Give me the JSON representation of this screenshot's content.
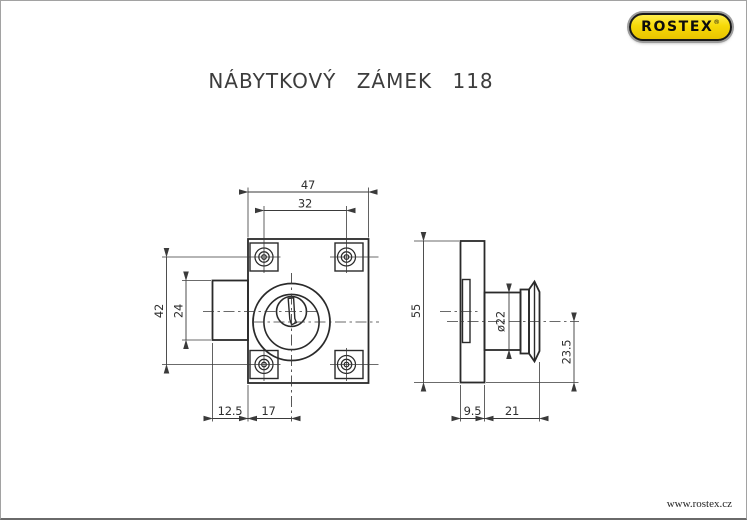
{
  "page": {
    "title": "NÁBYTKOVÝ ZÁMEK 118",
    "website": "www.rostex.cz"
  },
  "logo": {
    "brand": "ROSTEX",
    "registered": "®"
  },
  "views": {
    "front": {
      "label": "front-view-of-furniture-lock",
      "dims": {
        "overall_width": "47",
        "screw_spacing_width": "32",
        "screw_spacing_height": "42",
        "case_height": "24",
        "case_depth": "12.5",
        "edge_to_axis": "17"
      }
    },
    "side": {
      "label": "side-view-of-furniture-lock",
      "dims": {
        "plate_height": "55",
        "cylinder_diameter": "ø22",
        "axis_to_bottom": "23.5",
        "plate_thickness": "9.5",
        "cylinder_length": "21"
      }
    }
  },
  "colors": {
    "outline": "#2a2a2a",
    "dimension": "#3a3a3a",
    "logo_yellow": "#f6d908",
    "logo_border": "#191919"
  }
}
